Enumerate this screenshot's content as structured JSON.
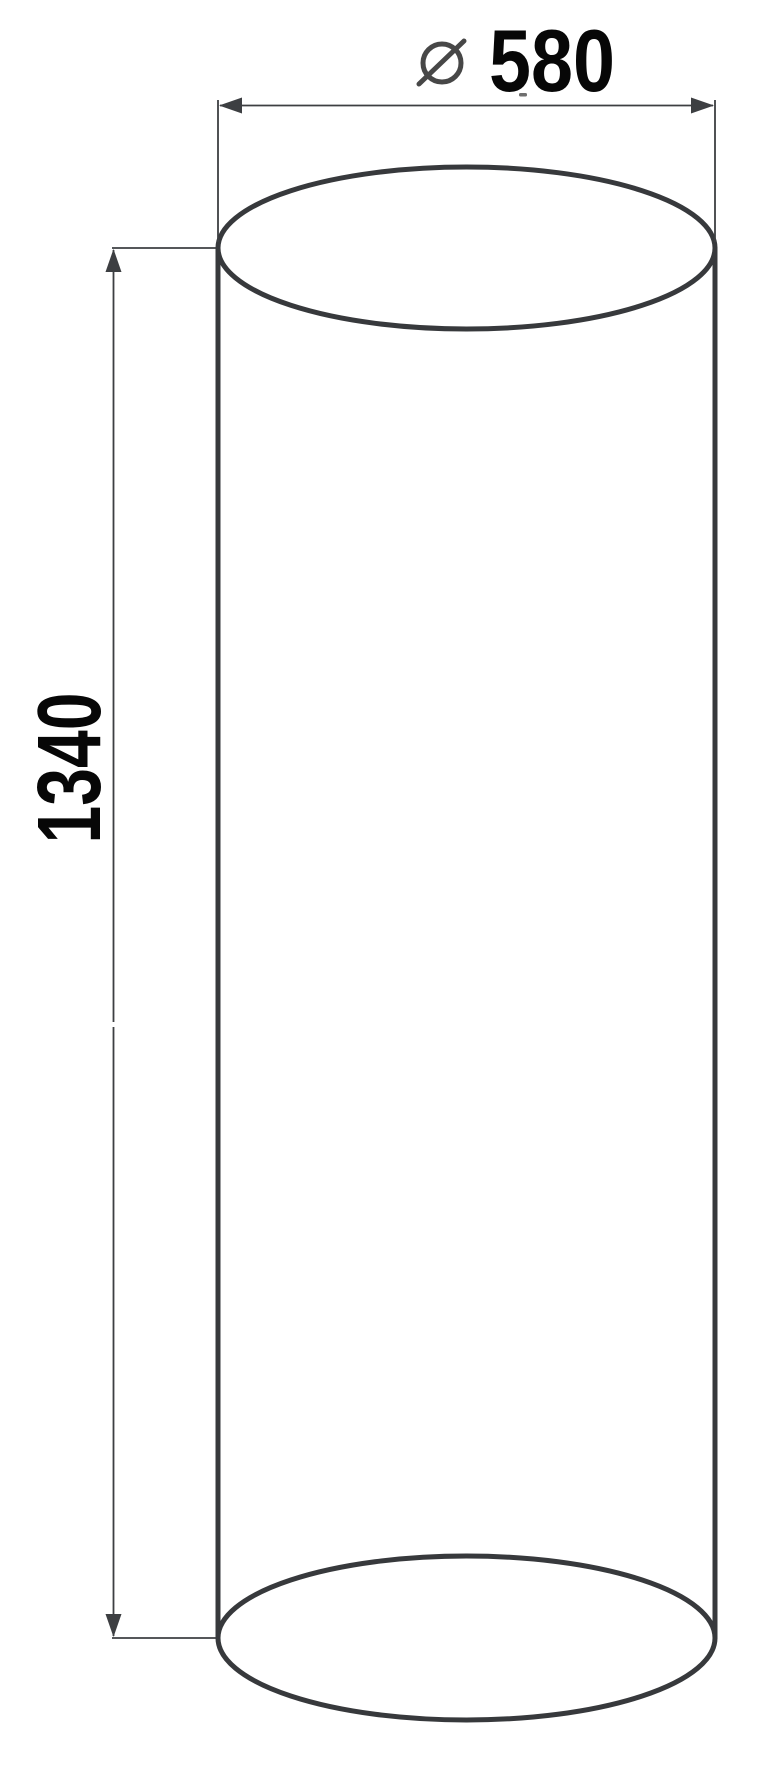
{
  "page": {
    "kind": "technical-drawing",
    "subject": "cylinder",
    "background": "#ffffff"
  },
  "drawing": {
    "colors": {
      "outline": "#37393c",
      "dimension_lines": "#3d3f42",
      "text": "#070707",
      "diameter_symbol": "#474747",
      "tick": "#6f6f6f",
      "background": "#ffffff"
    },
    "dimensions": {
      "diameter": {
        "symbol": "⌀",
        "value": "580",
        "full_label": "⌀ 580",
        "orientation": "horizontal",
        "position": "top"
      },
      "height": {
        "value": "1340",
        "full_label": "1340",
        "orientation": "vertical",
        "position": "left"
      }
    }
  }
}
